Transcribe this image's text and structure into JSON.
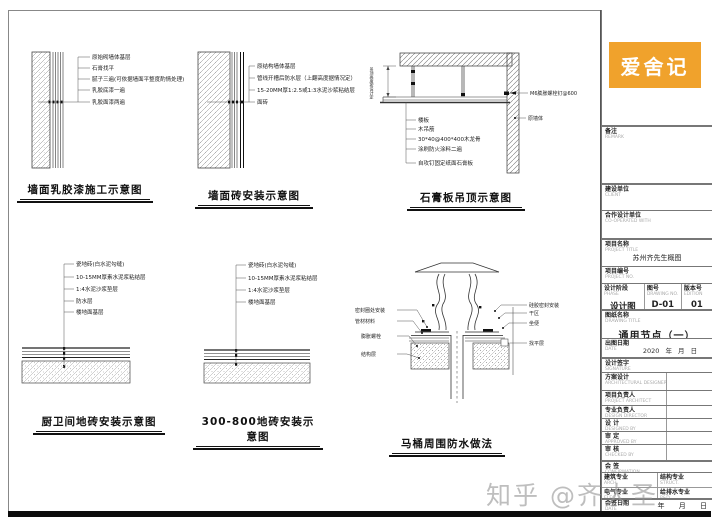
{
  "colors": {
    "accent": "#F0A22C",
    "line": "#333333",
    "paper": "#FFFFFF"
  },
  "logo": {
    "text": "爱舍记"
  },
  "watermark": {
    "text": "知乎 @齐大圣"
  },
  "drawings": {
    "d1": {
      "title": "墙面乳胶漆施工示意图",
      "labels": [
        "原始砌墙体基层",
        "石膏找平",
        "腻子三遍(可依据墙面平整度酌情处理)",
        "乳胶底漆一遍",
        "乳胶面漆两遍"
      ]
    },
    "d2": {
      "title": "墙面砖安装示意图",
      "labels": [
        "原结构墙体基层",
        "管线开槽后防水层（上翻高度据情况定）",
        "15-20MM厚1:2.5或1:3水泥沙浆粘结层",
        "面砖"
      ]
    },
    "d3": {
      "title": "石膏板吊顶示意图",
      "dim_note": "吊顶高度按设计定",
      "labels_left": [
        "楼板",
        "木吊筋",
        "30*40@400*400木龙骨",
        "涂刷防火涂料二遍",
        "自攻钉固定纸面石膏板"
      ],
      "labels_right": [
        "M6膨胀螺栓钉@600",
        "原墙体"
      ]
    },
    "d4": {
      "title": "厨卫间地砖安装示意图",
      "labels": [
        "瓷地砖(白水泥勾缝)",
        "10-15MM厚素水泥浆粘结层",
        "1:4水泥沙浆垫层",
        "防水层",
        "楼地面基层"
      ]
    },
    "d5": {
      "title": "300-800地砖安装示意图",
      "labels": [
        "瓷地砖(白水泥勾缝)",
        "10-15MM厚素水泥浆粘结层",
        "1:4水泥沙浆垫层",
        "楼地面基层"
      ]
    },
    "d6": {
      "title": "马桶周围防水做法",
      "labels_left": [
        "密封圈处安装",
        "管材材料",
        "膨胀螺栓",
        "结构层"
      ],
      "labels_right": [
        "硅胶密封安装",
        "干区",
        "坐便",
        "找平层"
      ]
    }
  },
  "titleblock": {
    "remark": {
      "label": "备注",
      "sub": "REMARK"
    },
    "client": {
      "label": "建设单位",
      "sub": "CLIENT"
    },
    "partner": {
      "label": "合作设计单位",
      "sub": "CO-OPERATED WITH"
    },
    "project": {
      "label": "项目名称",
      "sub": "PROJECT TITLE",
      "value": "苏州齐先生概图"
    },
    "project_no": {
      "label": "项目编号",
      "sub": "PROJECT NO."
    },
    "phase": {
      "label": "设计阶段",
      "sub": "PHASE",
      "value": "设计图"
    },
    "drawing_no": {
      "label": "图号",
      "sub": "DRAWING NO.",
      "value": "D-01"
    },
    "edition": {
      "label": "版本号",
      "sub": "EDITION",
      "value": "01"
    },
    "drawing_title": {
      "label": "图纸名称",
      "sub": "DRAWING TITLE",
      "value": "通用节点（一）"
    },
    "date": {
      "label": "出图日期",
      "sub": "DATE",
      "value": "2020 年 月 日"
    },
    "signature": {
      "label": "设计签字",
      "sub": "SIGNATURE"
    },
    "scheme": {
      "label": "方案设计",
      "sub": "ARCHITECTURAL DESIGNER"
    },
    "pm": {
      "label": "项目负责人",
      "sub": "PROJECT ARCHITECT"
    },
    "chief": {
      "label": "专业负责人",
      "sub": "DESIGN DIRECTOR"
    },
    "designed": {
      "label": "设 计",
      "sub": "DESIGNED BY"
    },
    "approved": {
      "label": "审 定",
      "sub": "APPROVED BY"
    },
    "checked": {
      "label": "审 核",
      "sub": "CHECKED BY"
    },
    "confirm": {
      "label": "会 签",
      "sub": "CONFIRMATION"
    },
    "disciplines": [
      {
        "label": "建筑专业",
        "sub": "ARCH."
      },
      {
        "label": "结构专业",
        "sub": "STRUCT."
      },
      {
        "label": "电气专业",
        "sub": "ELEC."
      },
      {
        "label": "给排水专业",
        "sub": "P&D"
      }
    ],
    "sign_date": {
      "label": "会签日期",
      "sub": "DATE",
      "value": "年 月 日"
    }
  }
}
